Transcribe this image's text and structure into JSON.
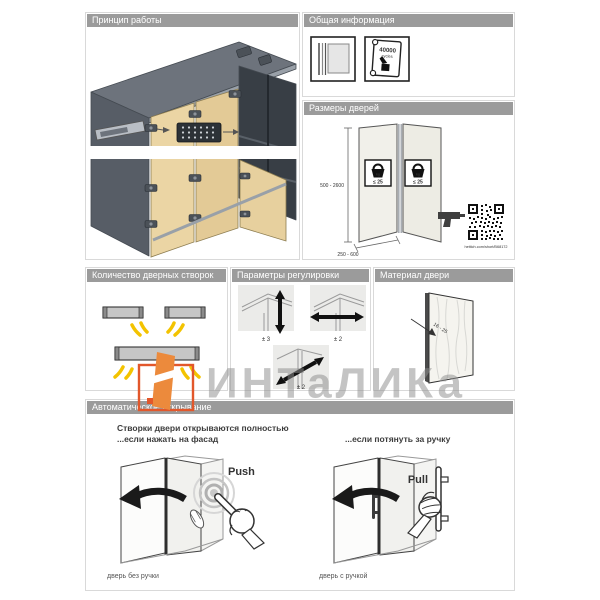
{
  "colors": {
    "header_gray": "#9b9b9b",
    "accent_orange": "#e2572b",
    "arrow_yellow": "#f3c300",
    "door_tan": "#ebd5a4",
    "cabinet_gray": "#6d737c"
  },
  "watermark": {
    "text": "ИНТаЛИКа"
  },
  "panels": {
    "principle": {
      "title": "Принцип работы"
    },
    "general_info": {
      "title": "Общая информация",
      "certificate_value": "40000",
      "certificate_unit": "cycles"
    },
    "door_sizes": {
      "title": "Размеры дверей",
      "height_range": "500 - 2600",
      "width_range": "250 - 600",
      "weight_limit": "≤ 25",
      "weight_unit": "kg",
      "link_text": "hettich.com/short/B68172"
    },
    "leaf_count": {
      "title": "Количество дверных створок"
    },
    "adjustment": {
      "title": "Параметры регулировки",
      "labels": [
        "± 3",
        "± 2",
        "± 2"
      ]
    },
    "door_material": {
      "title": "Материал двери",
      "thickness_range": "16 - 25"
    },
    "auto_opening": {
      "title": "Автоматическое открывание",
      "heading_line1": "Створки двери открываются полностью",
      "heading_line2": "...если нажать на фасад",
      "pull_heading": "...если потянуть за ручку",
      "push_label": "Push",
      "pull_label": "Pull",
      "caption_left": "дверь без ручки",
      "caption_right": "дверь с ручкой"
    }
  }
}
